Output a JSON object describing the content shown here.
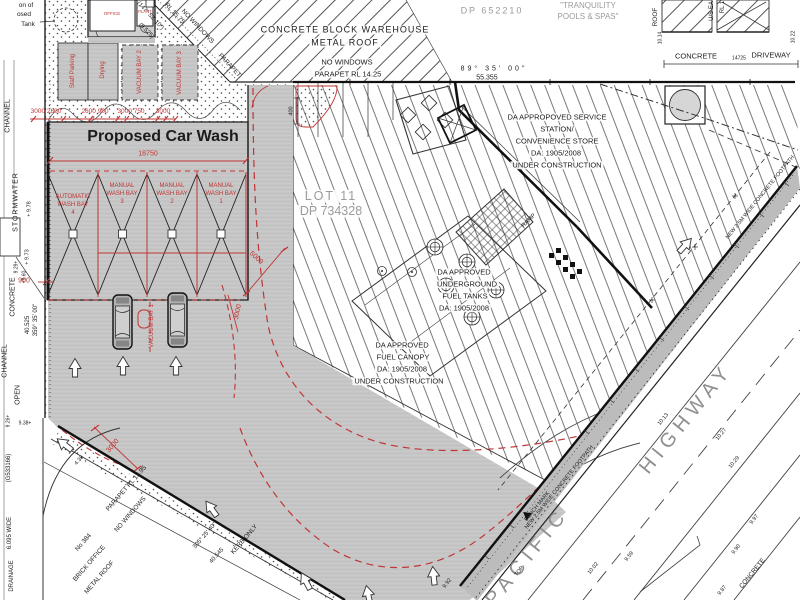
{
  "colors": {
    "red": "#c03535",
    "gray_fill": "#c5c5c5",
    "gray_text": "#9b9b9b",
    "ink": "#1c1c1c",
    "footpath": "#bcbcbc"
  },
  "title": "Proposed Car Wash",
  "carwash": {
    "overall_dim": "18750",
    "top_dims": [
      "3000 2600",
      "2600 900",
      "3000 750",
      "3000"
    ],
    "bays": [
      {
        "l1": "AUTOMATIC",
        "l2": "WASH BAY",
        "l3": "4"
      },
      {
        "l1": "MANUAL",
        "l2": "WASH BAY",
        "l3": "3"
      },
      {
        "l1": "MANUAL",
        "l2": "WASH BAY",
        "l3": "2"
      },
      {
        "l1": "MANUAL",
        "l2": "WASH BAY",
        "l3": "1"
      }
    ],
    "top_bays": [
      "Staff Parking",
      "Drying",
      "VACUUM BAY 2",
      "VACUUM BAY 3"
    ],
    "vacuum_bay_1": "VACUUM BAY 1",
    "rooms": [
      "OFFICE",
      "PLANT"
    ],
    "dim_5000": "5000",
    "dim_3000_arc": "3000",
    "dim_3000_kerb": "3000",
    "dim_900": "900",
    "dim_400": "400",
    "tank_note": [
      "on of",
      "osed",
      "Tank"
    ]
  },
  "neighbour_north": {
    "l1": "CONCRETE BLOCK WAREHOUSE",
    "l2": "METAL ROOF",
    "l3": "NO WINDOWS",
    "l4": "PARAPET  RL 14.25",
    "dp": "DP 652210",
    "business1": "\"TRANQUILITY",
    "business2": "POOLS & SPAS\"",
    "edge_bearing": "(147° 52' 10\")",
    "edge_dist": "(9.525)",
    "edge_rl": "RL 15.75",
    "edge_nowindows": "NO WINDOWS",
    "edge_parapet": "PARAPET"
  },
  "neighbour_ne": {
    "roof": "ROOF",
    "us_eave": "U/S EA",
    "rl": "RL 1",
    "lvl1": "10.14",
    "lvl2": "10.22",
    "concrete": "CONCRETE",
    "driveway": "DRIVEWAY",
    "dim": "14725"
  },
  "boundaries": {
    "north_bearing": "89° 35' 00\"",
    "north_dist": "55.355",
    "west_bearing": "359° 35' 00\"",
    "west_dist": "40.525",
    "south_bearing": "305° 25' 40\"",
    "south_dist": "40.545",
    "kerb_only": "KERB ONLY"
  },
  "lot": {
    "name": "LOT 11",
    "dp": "DP 734328",
    "station": [
      "DA APPROPOVED SERVICE",
      "STATION/",
      "CONVENIENCE STORE",
      "DA: 1905/2008",
      "UNDER CONSTRUCTION"
    ],
    "tanks": [
      "DA APPROVED",
      "UNDERGROUND",
      "FUEL TANKS",
      "DA: 1905/2008"
    ],
    "canopy": [
      "DA APPROVED",
      "FUEL CANOPY",
      "DA: 1905/2008",
      "UNDER CONSTRUCTION"
    ],
    "ramp": "RAMP"
  },
  "highway": {
    "name1": "PACIFIC",
    "name2": "HIGHWAY",
    "footpath": "NEW 2.5M WIDE CONCRETE FOOTPATH",
    "bench_mark": "BENCH MARK",
    "top": "TOP",
    "concrete": "CONCRETE",
    "levels": [
      "10.13",
      "10.27",
      "10.29",
      "10.02",
      "9.59",
      "9.97",
      "9.90",
      "9.87",
      "9.92"
    ]
  },
  "west": {
    "labels": [
      "CHANNEL",
      "STORMWATER",
      "CONCRETE",
      "CHANNEL",
      "OPEN"
    ],
    "levels": [
      "+ 9.78",
      "+ 9.73",
      "9.29+",
      "+9.60",
      "9.26+",
      "9.38+"
    ],
    "drainage": [
      "(G533166)",
      "6.095 WIDE",
      "DRAINAGE"
    ]
  },
  "south_building": {
    "no": "No 384",
    "l1": "BRICK OFFICE",
    "l2": "METAL ROOF",
    "l3": "NO WINDOWS",
    "l4": "PARAPET RL 13.95",
    "lvl": "4.38"
  }
}
